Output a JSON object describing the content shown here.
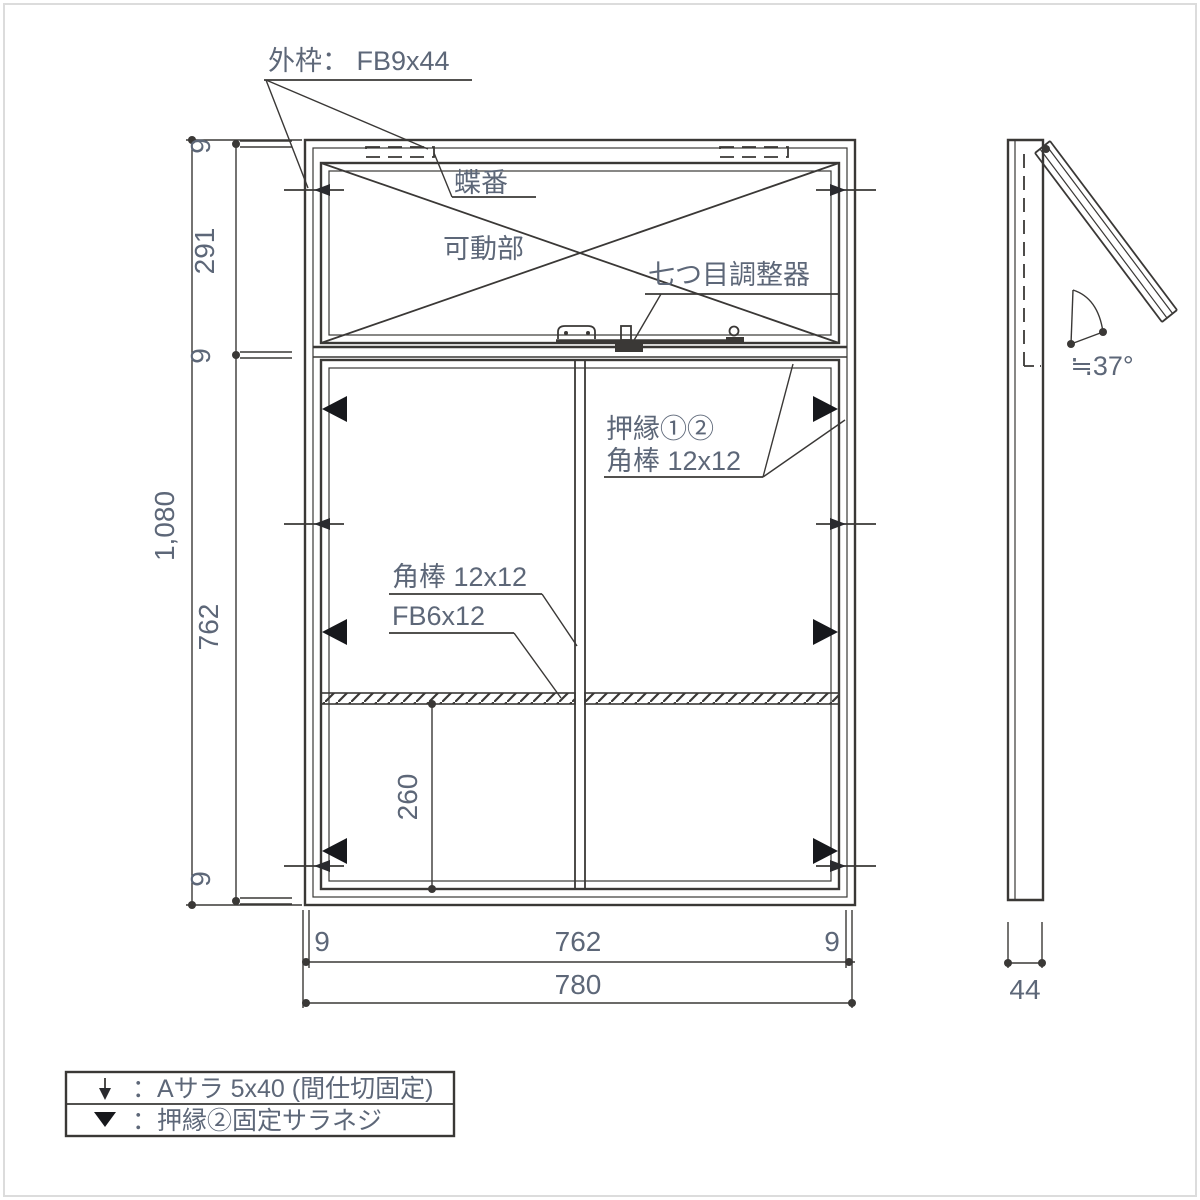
{
  "front_view": {
    "outer_frame_label": "外枠： FB9x44",
    "hinge_label": "蝶番",
    "movable_part_label": "可動部",
    "adjuster_label": "七つ目調整器",
    "bead_label_line1": "押縁①②",
    "bead_label_line2": "角棒 12x12",
    "square_bar_label": "角棒 12x12",
    "flat_bar_label": "FB6x12"
  },
  "dimensions": {
    "frame_top": "9",
    "upper_opening_height": "291",
    "middle_rail": "9",
    "overall_height": "1,080",
    "lower_opening_height": "762",
    "frame_bottom": "9",
    "lower_partition_offset": "260",
    "bottom_left_frame": "9",
    "bottom_inner_width": "762",
    "bottom_right_frame": "9",
    "overall_width": "780",
    "side_depth": "44",
    "open_angle": "≒37°"
  },
  "legend": {
    "rows": [
      {
        "symbol": "down-arrow",
        "text": "：Aサラ 5x40 (間仕切固定)"
      },
      {
        "symbol": "filled-triangle",
        "text": "：押縁②固定サラネジ"
      }
    ]
  },
  "colors": {
    "line": "#3a3836",
    "text": "#5d6778",
    "marker": "#17181c",
    "background": "#ffffff"
  }
}
